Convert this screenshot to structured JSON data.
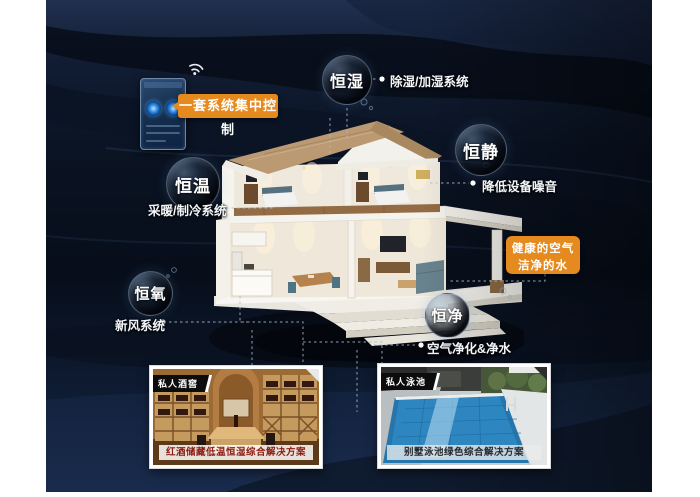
{
  "colors": {
    "accent_orange": "#e48a1f",
    "background_navy": "#0d1828",
    "caption_red": "#8a1a10"
  },
  "icons": {
    "wifi": "wifi-icon",
    "phone_screen": "smart-home-control-app",
    "house": "villa-cutaway-illustration"
  },
  "callouts": {
    "control": "一套系统集中控制",
    "health_line1": "健康的空气",
    "health_line2": "洁净的水"
  },
  "bubbles": [
    {
      "label": "恒湿",
      "desc": "除湿/加湿系统"
    },
    {
      "label": "恒静",
      "desc": "降低设备噪音"
    },
    {
      "label": "恒温",
      "desc": "采暖/制冷系统"
    },
    {
      "label": "恒氧",
      "desc": "新风系统"
    },
    {
      "label": "恒净",
      "desc": "空气净化&净水"
    }
  ],
  "cards": [
    {
      "tag": "私人酒窖",
      "caption": "红酒储藏低温恒湿综合解决方案"
    },
    {
      "tag": "私人泳池",
      "caption": "别墅泳池绿色综合解决方案"
    }
  ]
}
